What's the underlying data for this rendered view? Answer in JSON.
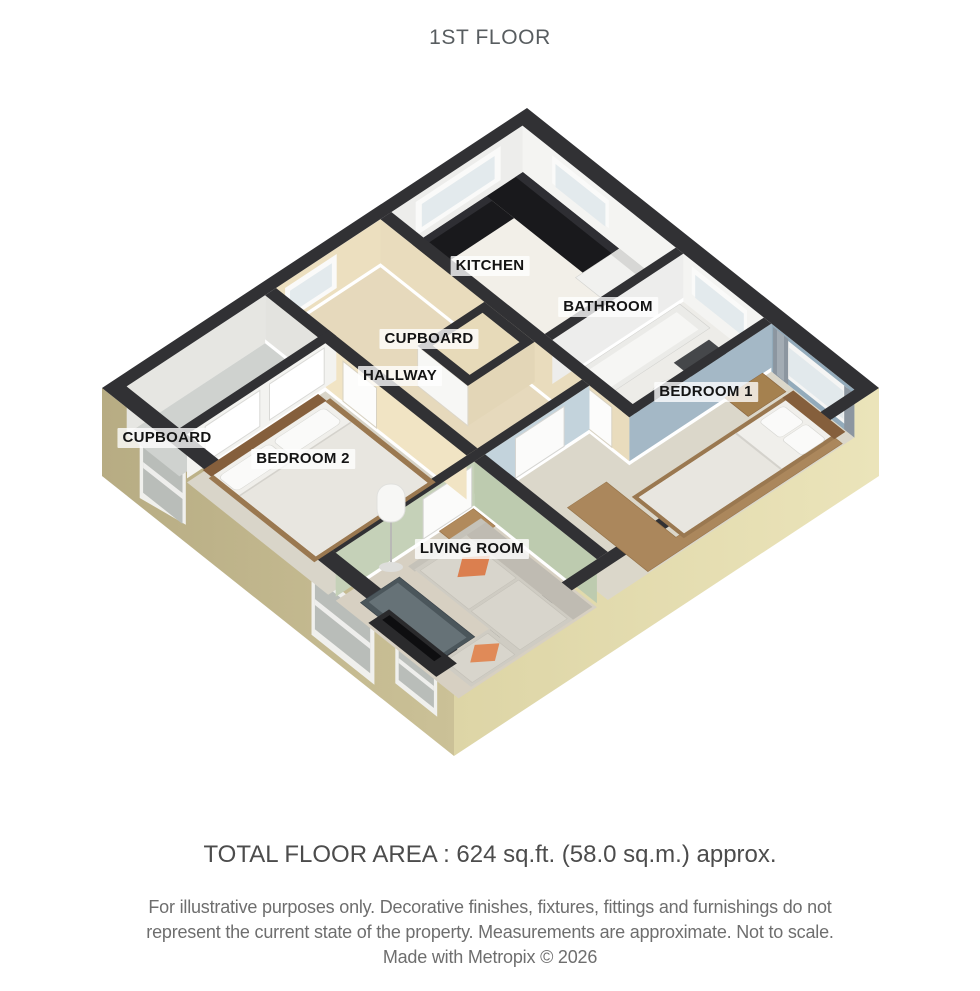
{
  "title": "1ST FLOOR",
  "rooms": [
    {
      "id": "kitchen",
      "label": "KITCHEN"
    },
    {
      "id": "bathroom",
      "label": "BATHROOM"
    },
    {
      "id": "cupboard-center",
      "label": "CUPBOARD"
    },
    {
      "id": "hallway",
      "label": "HALLWAY"
    },
    {
      "id": "bedroom-1",
      "label": "BEDROOM 1"
    },
    {
      "id": "cupboard-left",
      "label": "CUPBOARD"
    },
    {
      "id": "bedroom-2",
      "label": "BEDROOM 2"
    },
    {
      "id": "living-room",
      "label": "LIVING ROOM"
    }
  ],
  "footer": {
    "total_area": "TOTAL FLOOR AREA : 624 sq.ft. (58.0 sq.m.) approx.",
    "disclaimer_line1": "For illustrative purposes only. Decorative finishes, fixtures, fittings and furnishings do not",
    "disclaimer_line2": "represent the current state of the property. Measurements are approximate. Not to scale.",
    "credit": "Made with Metropix © 2026"
  },
  "palette": {
    "wall_top": "#313134",
    "exterior_wall_left": "#c3b98e",
    "exterior_wall_right": "#e5deb0",
    "bedroom1_wall_blue": "#93abbb",
    "living_wall_green": "#c5d1b8",
    "bedroom2_wall_cream": "#f1e4c4",
    "hallway_wall_beige": "#e9dcbd",
    "cushion_orange": "#db7f4f",
    "carpet_gray": "#d9d5c9"
  }
}
